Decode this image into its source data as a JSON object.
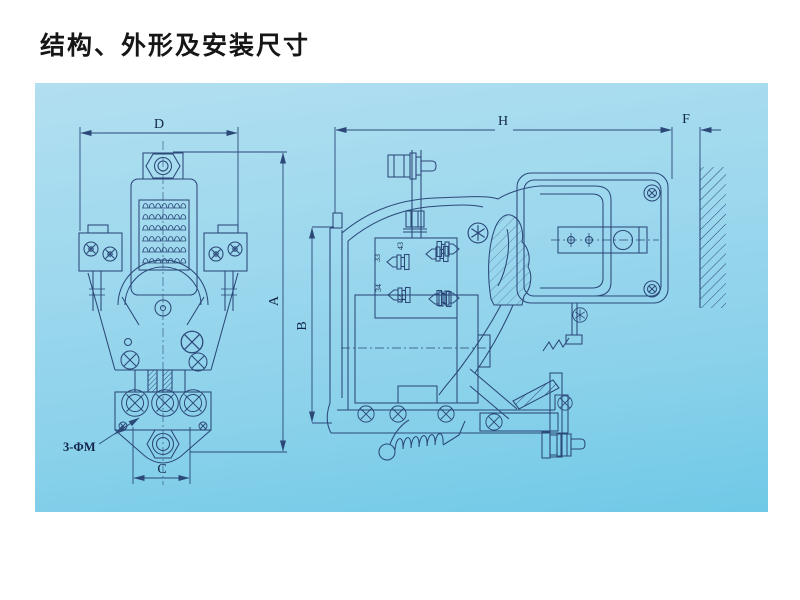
{
  "title": "结构、外形及安装尺寸",
  "drawing": {
    "panel_color": "#9ad6ec",
    "line_color": "#2b4878",
    "dimensions": {
      "width_top": "D",
      "height_overall": "A",
      "mounting_width": "C",
      "depth_overall": "H",
      "panel_gap": "F",
      "height_side": "B"
    },
    "annotations": {
      "mounting_holes": "3-ΦM"
    },
    "aux_terminals": {
      "t43": "43",
      "t33": "33",
      "t34": "34",
      "t44": "44"
    }
  }
}
